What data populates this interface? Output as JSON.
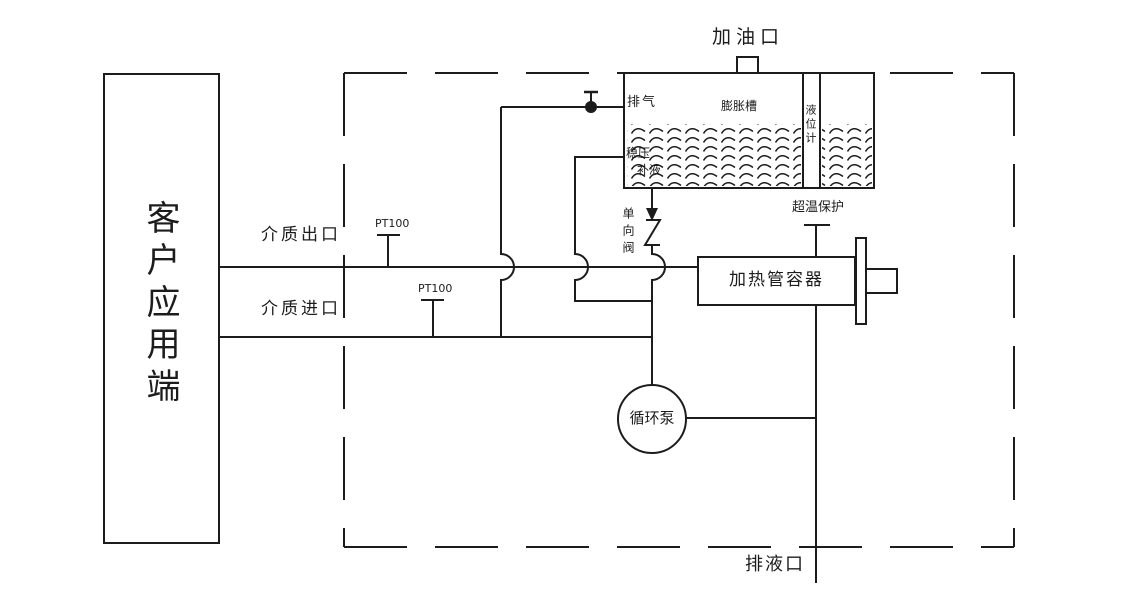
{
  "diagram": {
    "title_hint": "heat-transfer-oil circulation system schematic",
    "customer_box": {
      "label": "客户应用端"
    },
    "labels": {
      "oil_fill_port": "加油口",
      "exhaust": "排气",
      "expansion_tank": "膨胀槽",
      "level_gauge": "液位计",
      "pressure_stabilize": "稳压",
      "liquid_replenish": "补液",
      "medium_outlet": "介质出口",
      "medium_inlet": "介质进口",
      "pt100_outlet": "PT100",
      "pt100_inlet": "PT100",
      "check_valve": "单向阀",
      "heater_vessel": "加热管容器",
      "overtemp_protection": "超温保护",
      "circulation_pump": "循环泵",
      "drain_port": "排液口"
    },
    "colors": {
      "line": "#1c1c1c",
      "background": "#ffffff"
    }
  }
}
